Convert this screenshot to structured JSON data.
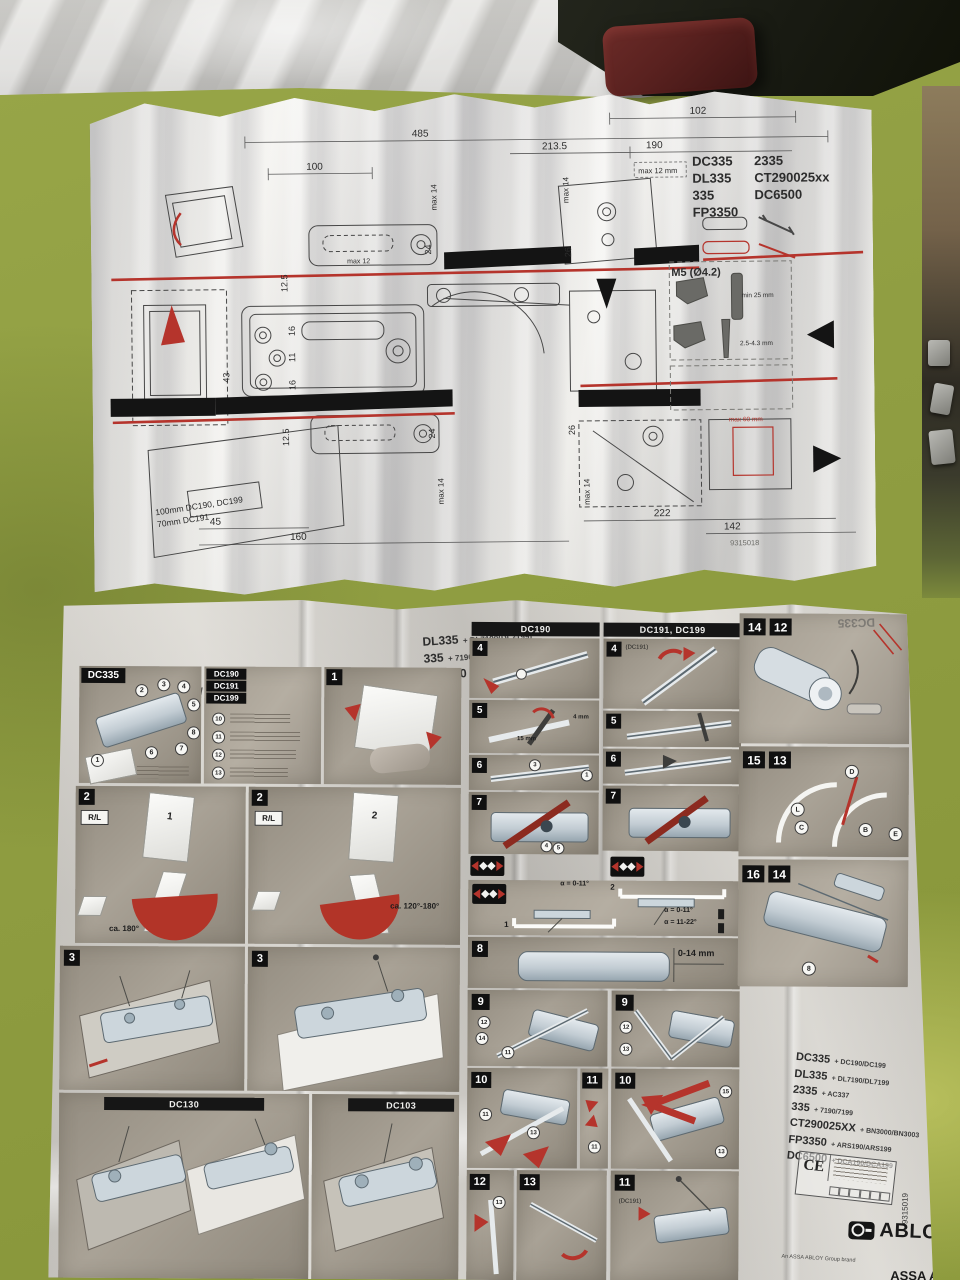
{
  "top_sheet": {
    "dims": {
      "d102": "102",
      "d190": "190",
      "d2135": "213.5",
      "d485": "485",
      "d100": "100",
      "max12mm": "max 12 mm",
      "max12": "max 12",
      "v24a": "24",
      "vmax14a": "max 14",
      "v26a": "26",
      "vmax14r": "max 14",
      "v125a": "12.5",
      "v16a": "16",
      "v11": "11",
      "v16b": "16",
      "v43": "43",
      "v125b": "12.5",
      "v24b": "24",
      "vmax14b": "max 14",
      "v26b": "26",
      "vmax14c": "max 14",
      "d45": "45",
      "d160": "160",
      "d222": "222",
      "d142": "142",
      "max60": "max 60 mm"
    },
    "models_col1": [
      "DC335",
      "DL335",
      "335",
      "FP3350"
    ],
    "models_col2": [
      "2335",
      "CT290025xx",
      "DC6500"
    ],
    "m5": "M5 (Ø4.2)",
    "min25": "min 25 mm",
    "drill": "2.5-4.3 mm",
    "offset_line1": "100mm DC190, DC199",
    "offset_line2": "70mm DC191",
    "doc_number": "9315018"
  },
  "bottom_sheet": {
    "title": "DC335",
    "title_suffix": "+ DC190 / DC199 / DC191",
    "compat_col1": [
      {
        "code": "DL335",
        "suffix": "+ DL7190(DL7199)"
      },
      {
        "code": "335",
        "suffix": "+ 7190(7199)"
      },
      {
        "code": "FP3350",
        "suffix": "+ ARS190(ARS199)"
      }
    ],
    "compat_col2": [
      {
        "code": "2335",
        "suffix": "+ AC337"
      },
      {
        "code": "CT290025XX",
        "suffix": "+ BN3000(BN3003)"
      },
      {
        "code": "DC6500",
        "suffix": "+ DCA190(DCA199)"
      }
    ],
    "panels": {
      "dc335_label": "DC335",
      "dc19x_labels": [
        "DC190",
        "DC191",
        "DC199"
      ],
      "col_a_header": "DC190",
      "col_b_header": "DC191, DC199",
      "dc130_label": "DC130",
      "dc103_label": "DC103"
    },
    "steps": {
      "s1": "1",
      "s2a": "2",
      "s2b": "2",
      "s3a": "3",
      "s3b": "3",
      "s4a": "4",
      "s4b": "4",
      "s5a": "5",
      "s5b": "5",
      "s6a": "6",
      "s6b": "6",
      "s7a": "7",
      "s7b": "7",
      "s8": "8",
      "s9a": "9",
      "s9b": "9",
      "s10a": "10",
      "s10b": "10",
      "s11a": "11",
      "s11b": "11",
      "s12": "12",
      "s13": "13",
      "s14a": "14",
      "s12r": "12",
      "s15": "15",
      "s13r": "13",
      "s16": "16",
      "s14r": "14"
    },
    "notes": {
      "rl_a": "R/L",
      "rl_b": "R/L",
      "arc_a": "ca. 180°",
      "arc_b": "ca. 120°-180°",
      "alpha1": "α = 0-11°",
      "alpha2": "α = 0-11°",
      "alpha3": "α = 11-22°",
      "range": "0-14 mm",
      "wrench": "15 mm",
      "hex": "4 mm",
      "dc191_note_a": "(DC191)",
      "dc191_note_b": "(DC191)",
      "frame1": "1",
      "frame2": "2",
      "door1": "1",
      "door2": "2"
    },
    "circled": {
      "dc335_parts": [
        "1",
        "2",
        "3",
        "4",
        "5",
        "6",
        "7",
        "8"
      ],
      "dc19x_parts": [
        "10",
        "11",
        "12",
        "13",
        "14"
      ],
      "step6a": [
        "3",
        "1"
      ],
      "step7a": [
        "4",
        "5"
      ],
      "step9a": [
        "12",
        "14",
        "11"
      ],
      "step9b": [
        "12",
        "13"
      ],
      "step10a": [
        "11",
        "13"
      ],
      "step10b": [
        "15",
        "13"
      ],
      "letters": [
        "D",
        "L",
        "C",
        "B",
        "E"
      ],
      "step16": "8"
    },
    "right_block": [
      {
        "code": "DC335",
        "suffix": "+ DC190/DC199"
      },
      {
        "code": "DL335",
        "suffix": "+ DL7190/DL7199"
      },
      {
        "code": "2335",
        "suffix": "+ AC337"
      },
      {
        "code": "335",
        "suffix": "+ 7190/7199"
      },
      {
        "code": "CT290025XX",
        "suffix": "+ BN3000/BN3003"
      },
      {
        "code": "FP3350",
        "suffix": "+ ARS190/ARS199"
      },
      {
        "code": "DC6500",
        "suffix": "+ DCA190/DCA199"
      }
    ],
    "ce_mark": "CE",
    "brand": {
      "logo": "ABLOY",
      "assa": "ASSA ABLOY",
      "group_line": "An ASSA ABLOY Group brand",
      "doc_number": "9315019"
    }
  },
  "colors": {
    "accent_red": "#b5342c",
    "table_green": "#93a23c",
    "paper": "#f3f2ee",
    "panel_gray": "#9b958b"
  }
}
